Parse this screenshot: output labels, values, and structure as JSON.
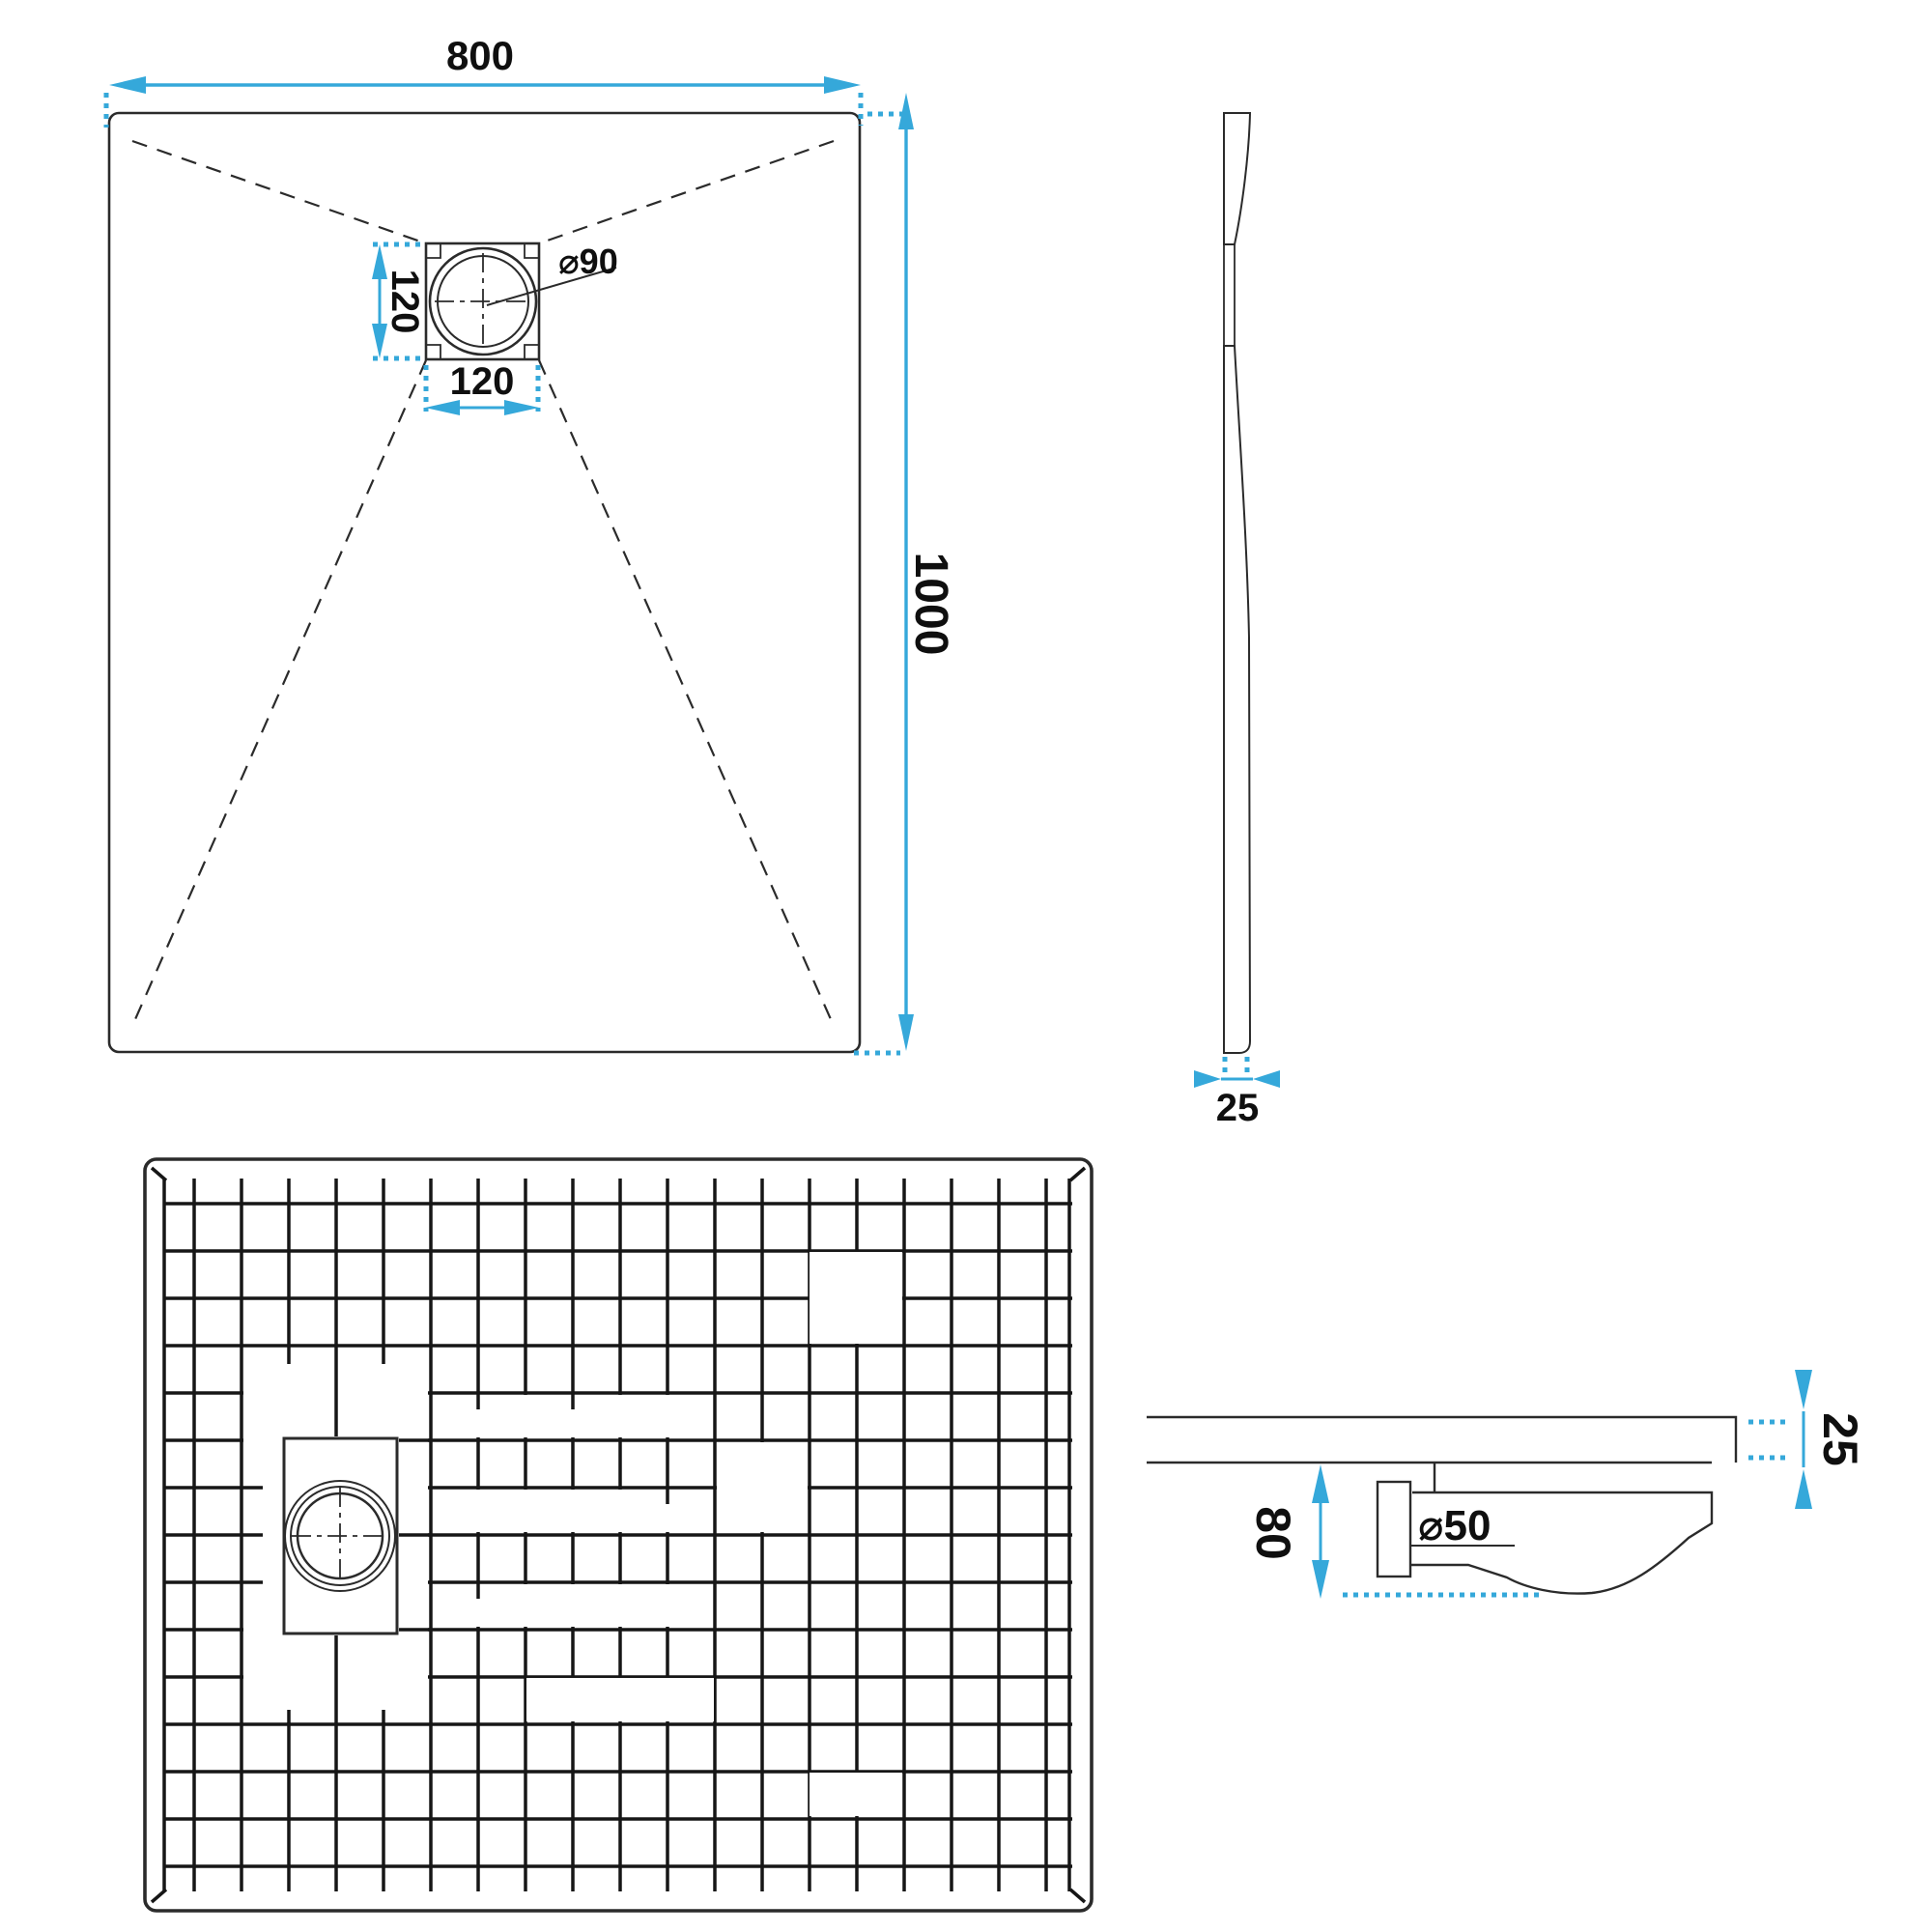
{
  "title": "Shower tray technical drawing",
  "colors": {
    "accent": "#35A8DA",
    "line": "#2b2b2b",
    "text": "#0f0f0f",
    "background": "#ffffff"
  },
  "views": {
    "top": {
      "label": "top-view",
      "width_mm": "800",
      "length_mm": "1000",
      "drain_offset_vertical_mm": "120",
      "drain_offset_horizontal_mm": "120",
      "drain_diameter": "⌀90"
    },
    "side": {
      "label": "side-section-view",
      "thickness_mm": "25"
    },
    "texture": {
      "label": "surface-texture-view"
    },
    "detail": {
      "label": "drain-section-detail",
      "tray_thickness_mm": "25",
      "drain_height_mm": "80",
      "waste_pipe_diameter": "⌀50"
    }
  }
}
